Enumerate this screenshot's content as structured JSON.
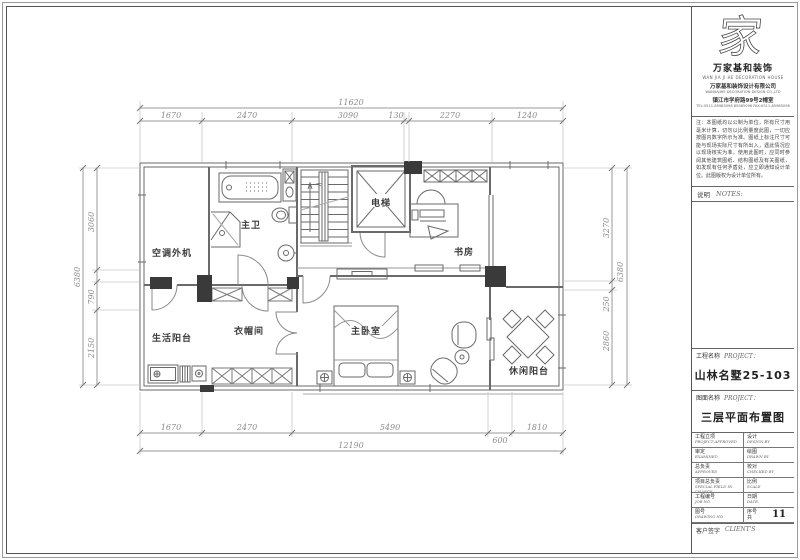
{
  "sheet": {
    "bg": "#ffffff",
    "line_color": "#6a6a6a",
    "dim_color": "#8c8c8c",
    "label_color": "#3c3c3c",
    "column_color": "#3a3a3a"
  },
  "plan": {
    "rooms": {
      "ac_outdoor": "空调外机",
      "master_bath": "主卫",
      "elevator": "电梯",
      "study": "书房",
      "living_balcony": "生活阳台",
      "cloakroom": "衣帽间",
      "master_bedroom": "主卧室",
      "leisure_balcony": "休闲阳台"
    },
    "stair_direction": "下"
  },
  "dimensions": {
    "top": {
      "total": "11620",
      "segments": [
        "1670",
        "2470",
        "3090",
        "130",
        "2270",
        "1240"
      ]
    },
    "bottom": {
      "total": "12190",
      "segments": [
        "1670",
        "2470",
        "5490",
        "600",
        "1810"
      ]
    },
    "left": {
      "total": "6380",
      "segments": [
        "3060",
        "790",
        "2150"
      ]
    },
    "right": {
      "total": "6380",
      "segments": [
        "3270",
        "250",
        "2860"
      ]
    }
  },
  "title_block": {
    "logo_glyph": "家",
    "company_name": "万家基和装饰",
    "company_name_en": "WAN JIA JI HE DECORATION HOUSE",
    "company_full": "万家基和装饰设计有限公司",
    "company_full_en": "WANJIAJIHE DECORATION DESIGN CO.,LTD",
    "company_addr": "镇江市学府路99号2幢室",
    "company_tel": "TEL:0511-85985098 85985096  FAX:0511-85985098",
    "notes_text": "注：本图纸均以公制为单位，所有尺寸用毫米计算，切勿以比例量度此图，一切应按图内数字所示为准。图纸上标注尺寸可能与现场实际尺寸有所出入，遇此情况应以现场核实为准。使用此图时，应同时参阅其他建筑图纸、结构图纸及有关图纸，如发现有任何矛盾处，应立即通知设计单位。此图版权为设计单位所有。",
    "notes_label": "说明",
    "notes_label_en": "NOTES:",
    "project_label": "工程名称",
    "project_label_en": "PROJECT：",
    "project_value": "山林名墅25-103",
    "drawing_label": "图面名称",
    "drawing_label_en": "PROJECT：",
    "drawing_value": "三层平面布置图",
    "rows": [
      {
        "l": "工程立项",
        "le": "PROJECT APPROVED",
        "r": "设计",
        "re": "DESIGN BY"
      },
      {
        "l": "审定",
        "le": "EXAMINED",
        "r": "绘图",
        "re": "DRAWN BY"
      },
      {
        "l": "总负责",
        "le": "APPROVED",
        "r": "校对",
        "re": "CHECKED BY"
      },
      {
        "l": "项目总负责",
        "le": "SPECIAL FIELD IN CHARGE",
        "r": "比例",
        "re": "SCALE"
      },
      {
        "l": "工程编号",
        "le": "JOB NO",
        "r": "日期",
        "re": "DATE"
      },
      {
        "l": "图号",
        "le": "DRAWING NO",
        "r": "序号",
        "re": "共"
      }
    ],
    "sheet_number": "11",
    "client_label": "客户签字",
    "client_label_en": "CLIENT'S"
  }
}
